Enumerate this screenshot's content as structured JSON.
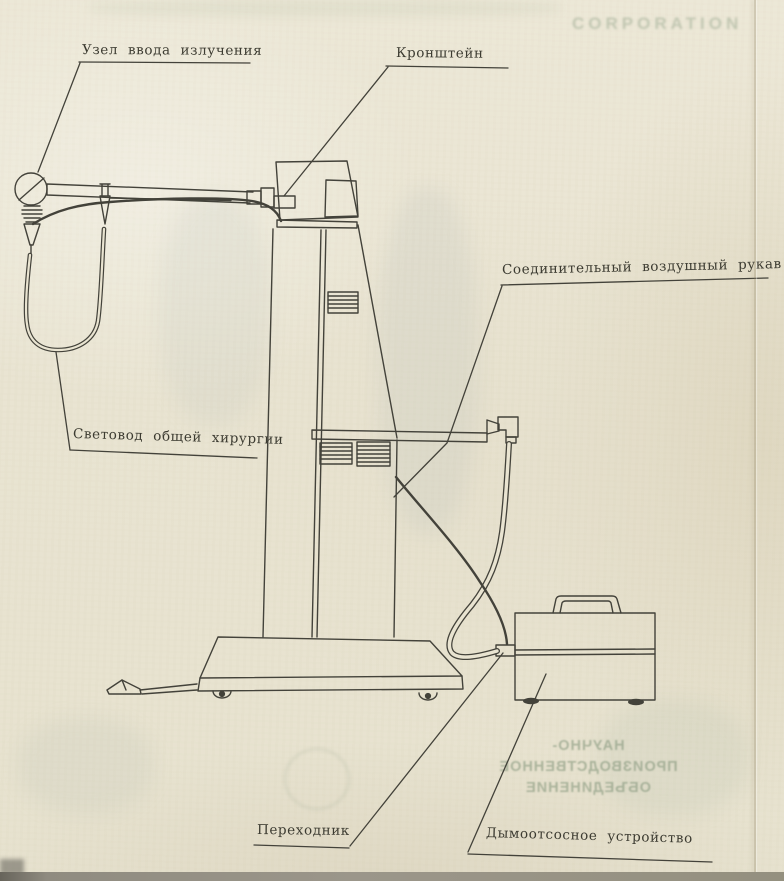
{
  "page": {
    "kind": "scanned technical diagram page",
    "paper_color": "#e9e4d1",
    "ink_color": "#43423a",
    "bleedthrough_color": "#8c9c80"
  },
  "labels": {
    "uzel_vvoda": "Узел ввода излучения",
    "kronshtein": "Кронштейн",
    "soedinitelny": "Соединительный воздушный рукав",
    "svetovod": "Световод общей хирургии",
    "perekhodnik": "Переходник",
    "dymootsos": "Дымоотсосное устройство"
  },
  "ghost": {
    "corporation": "CORPORATION",
    "npo_line1": "НАУЧНО-",
    "npo_line2": "ПРОИЗВОДСТВЕННОЕ",
    "npo_line3": "ОБЪЕДИНЕНИЕ"
  }
}
